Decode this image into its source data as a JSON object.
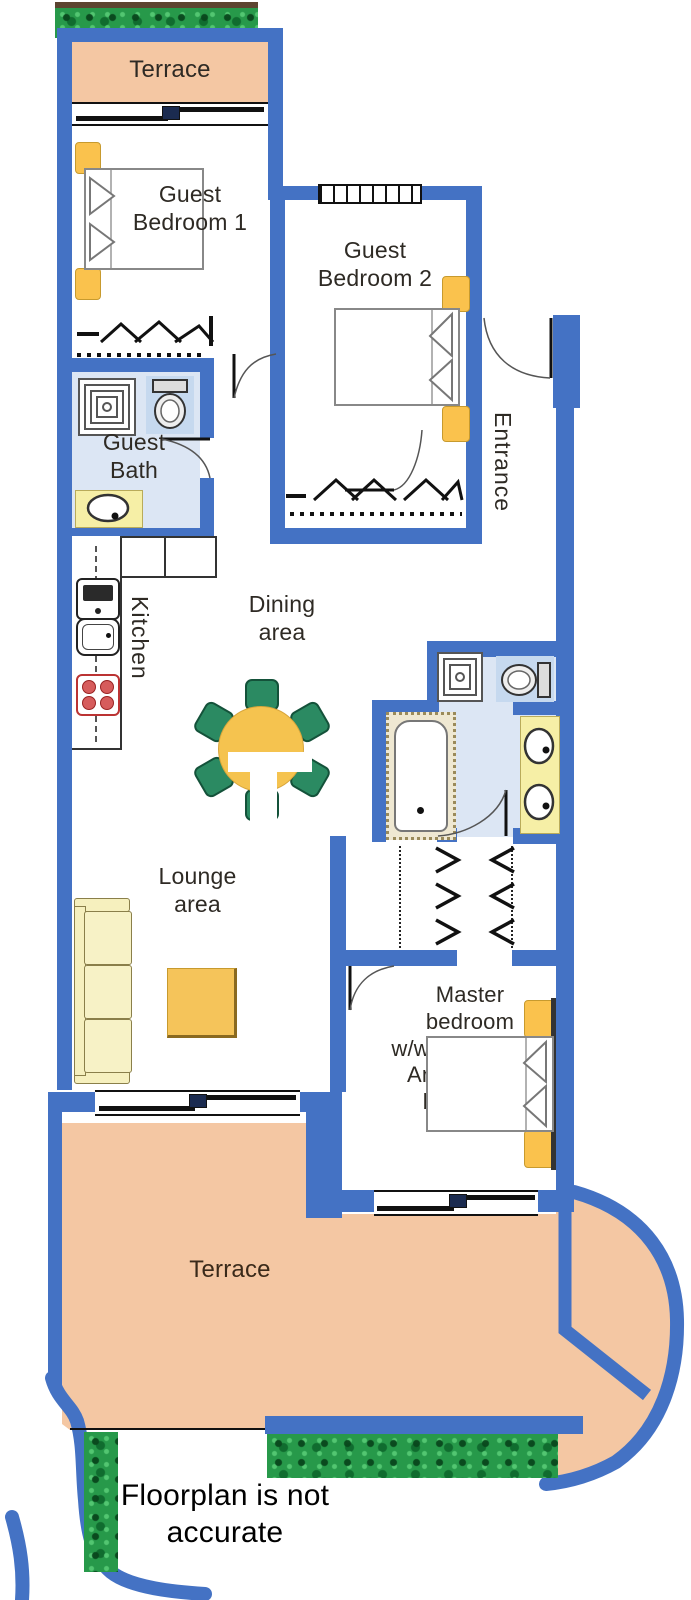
{
  "rooms": {
    "terrace_top": "Terrace",
    "guest_bedroom_1": "Guest\nBedroom 1",
    "guest_bedroom_2": "Guest\nBedroom 2",
    "entrance": "Entrance",
    "guest_bath": "Guest\nBath",
    "kitchen": "Kitchen",
    "dining_area": "Dining\narea",
    "lounge_area": "Lounge\narea",
    "master_bedroom": "Master\nbedroom\nw/walk-in closet\nAnd en-suite\nbathroom",
    "terrace_bottom": "Terrace"
  },
  "disclaimer": "Floorplan is not\naccurate",
  "colors": {
    "wall": "#4472C4",
    "terrace_floor": "#F4C7A3",
    "bathroom_floor": "#DCE6F4",
    "furniture_yellow": "#FAC24D",
    "sofa_cream": "#F6F0BE",
    "counter_cream": "#F6EFA6",
    "chair_green": "#2B8A62",
    "table_yellow": "#F5C34F",
    "greenery_green": "#27994A",
    "hob_red": "#D65C5C"
  }
}
